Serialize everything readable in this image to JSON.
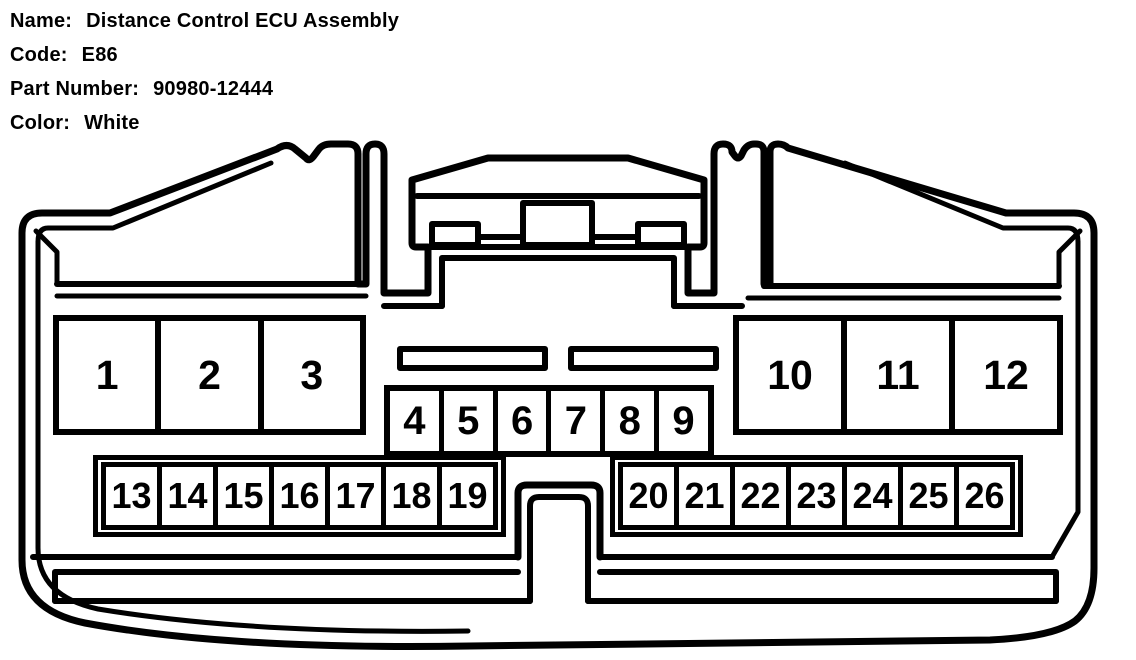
{
  "header": {
    "name_label": "Name:",
    "name_value": "Distance Control ECU Assembly",
    "code_label": "Code:",
    "code_value": "E86",
    "part_number_label": "Part Number:",
    "part_number_value": "90980-12444",
    "color_label": "Color:",
    "color_value": "White"
  },
  "connector": {
    "description": "26-pin connector cavity diagram, front view",
    "line_color": "#000000",
    "background_color": "#ffffff",
    "pin_rows": {
      "top_left": [
        "1",
        "2",
        "3"
      ],
      "top_right": [
        "10",
        "11",
        "12"
      ],
      "middle": [
        "4",
        "5",
        "6",
        "7",
        "8",
        "9"
      ],
      "bottom_left": [
        "13",
        "14",
        "15",
        "16",
        "17",
        "18",
        "19"
      ],
      "bottom_right": [
        "20",
        "21",
        "22",
        "23",
        "24",
        "25",
        "26"
      ]
    }
  }
}
